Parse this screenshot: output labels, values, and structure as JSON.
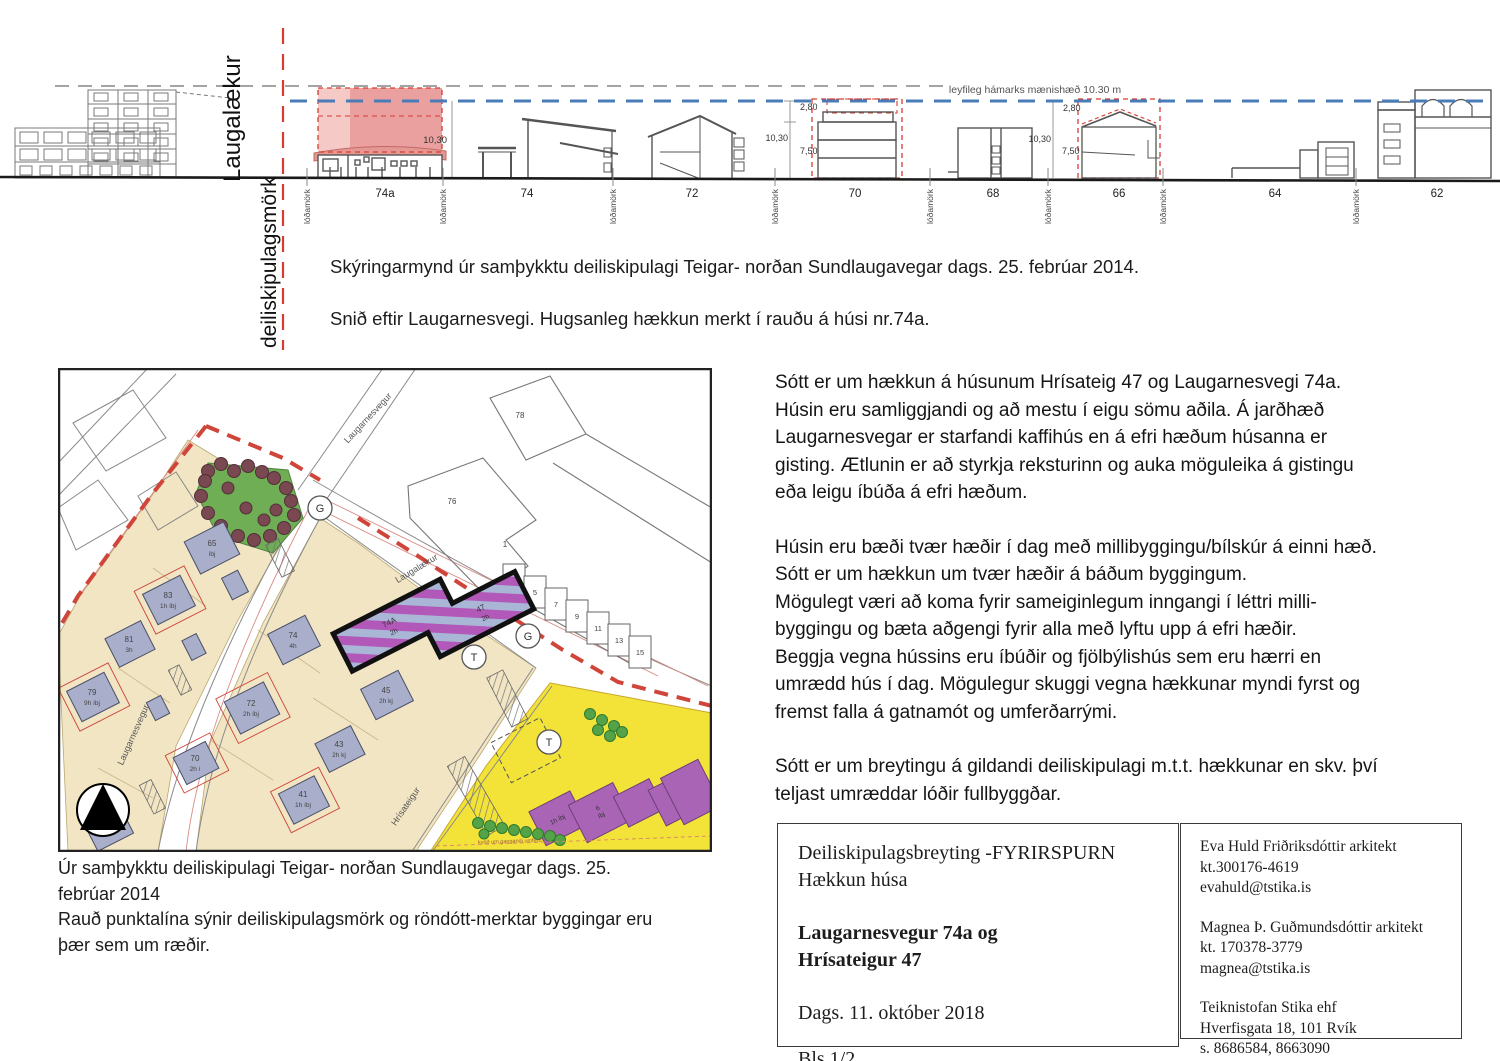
{
  "colors": {
    "red_dashed": "#d63c30",
    "blue_dashed": "#4a7db8",
    "highlight_pink": "#eba0a0",
    "map_tan": "#f1e5c3",
    "map_building": "#a9aecb",
    "map_yellow": "#f3e339",
    "map_purple": "#b158b8",
    "map_green": "#6fae54"
  },
  "elevation": {
    "street_label": "Laugalækur",
    "boundary_label": "deiliskipulagsmörk",
    "max_height_note": "leyfileg hámarks mænishæð 10.30 m",
    "lot_boundary_label": "lóðamörk",
    "houses": [
      "74a",
      "74",
      "72",
      "70",
      "68",
      "66",
      "64",
      "62"
    ],
    "dim_74a": "10,30",
    "dims_70": {
      "top": "2,80",
      "mid": "10,30",
      "low": "7,50"
    },
    "dims_66": {
      "top": "2,80",
      "mid": "10,30",
      "low": "7,50"
    }
  },
  "elevation_caption": {
    "line1": "Skýringarmynd úr samþykktu deiliskipulagi Teigar- norðan Sundlaugavegar dags. 25. febrúar 2014.",
    "line2": "Snið eftir Laugarnesvegi. Hugsanleg hækkun merkt í rauðu á húsi nr.74a."
  },
  "map": {
    "streets": {
      "laugarnesvegur_top": "Laugarnesvegur",
      "laugarnesvegur_bottom": "Laugarnesvegur",
      "laugalaekur": "Laugalækur",
      "hrisateigur": "Hrísateigur"
    },
    "circles": {
      "g": "G",
      "t": "T"
    },
    "target": {
      "a_no": "74A",
      "a_fl": "2h",
      "b_no": "47",
      "b_fl": "2h"
    },
    "lots": {
      "l76": "76",
      "l78": "78",
      "l1": "1",
      "l65": "65",
      "l65s": "íbj",
      "l83": "83",
      "l83s": "1h íbj",
      "l81": "81",
      "l81s": "3h",
      "l79": "79",
      "l79s": "9h íbj",
      "l74": "74",
      "l74s": "4h",
      "l72": "72",
      "l72s": "2h íbj",
      "l70": "70",
      "l70s": "2h í",
      "l68": "68",
      "l68s": "3h",
      "l45": "45",
      "l45s": "2h kj",
      "l43": "43",
      "l43s": "2h kj",
      "l41": "41",
      "l41s": "1h íbj",
      "l6": "6",
      "l6s": "íbj",
      "y1": "1h íbj"
    },
    "rowhouses": [
      "3",
      "5",
      "7",
      "9",
      "11",
      "13",
      "15"
    ],
    "easement": "kvöð um gangandi umferð"
  },
  "map_caption": {
    "text": "Úr samþykktu deiliskipulagi Teigar- norðan Sundlaugavegar dags. 25.\nfebrúar 2014\nRauð punktalína sýnir deiliskipulagsmörk og röndótt-merktar byggingar eru\nþær sem um ræðir."
  },
  "body": {
    "p1": "Sótt er um hækkun á húsunum Hrísateig 47 og Laugarnesvegi 74a.\nHúsin eru samliggjandi og að mestu í eigu sömu aðila. Á jarðhæð\nLaugarnesvegar er starfandi kaffihús en á efri hæðum húsanna er\ngisting. Ætlunin er að styrkja reksturinn og auka möguleika á gistingu\neða leigu íbúða á efri hæðum.",
    "p2": "Húsin eru bæði tvær hæðir í dag með millibyggingu/bílskúr á einni hæð.\nSótt er um hækkun um tvær hæðir á báðum byggingum.\nMögulegt væri að koma fyrir sameiginlegum inngangi í léttri milli-\nbyggingu og bæta aðgengi fyrir alla með lyftu upp á efri hæðir.\nBeggja vegna hússins eru íbúðir og fjölbýlishús sem eru hærri en\numrædd hús í dag. Mögulegur skuggi vegna hækkunar myndi fyrst og\nfremst falla á gatnamót og umferðarrými.",
    "p3": "Sótt er um breytingu á gildandi deiliskipulagi m.t.t. hækkunar en skv. því\nteljast umræddar lóðir fullbyggðar."
  },
  "title_block": {
    "left": {
      "line1": "Deiliskipulagsbreyting -FYRIRSPURN",
      "line2": "Hækkun húsa",
      "project1": "Laugarnesvegur 74a og",
      "project2": "Hrísateigur 47",
      "date": "Dags. 11. október 2018",
      "page": "Bls.1/2"
    },
    "right": {
      "a1": "Eva Huld Friðriksdóttir arkitekt",
      "a2": "kt.300176-4619",
      "a3": "evahuld@tstika.is",
      "b1": "Magnea Þ. Guðmundsdóttir arkitekt",
      "b2": "kt. 170378-3779",
      "b3": "magnea@tstika.is",
      "c1": "Teiknistofan Stika ehf",
      "c2": "Hverfisgata 18, 101 Rvík",
      "c3": "s. 8686584, 8663090"
    }
  }
}
